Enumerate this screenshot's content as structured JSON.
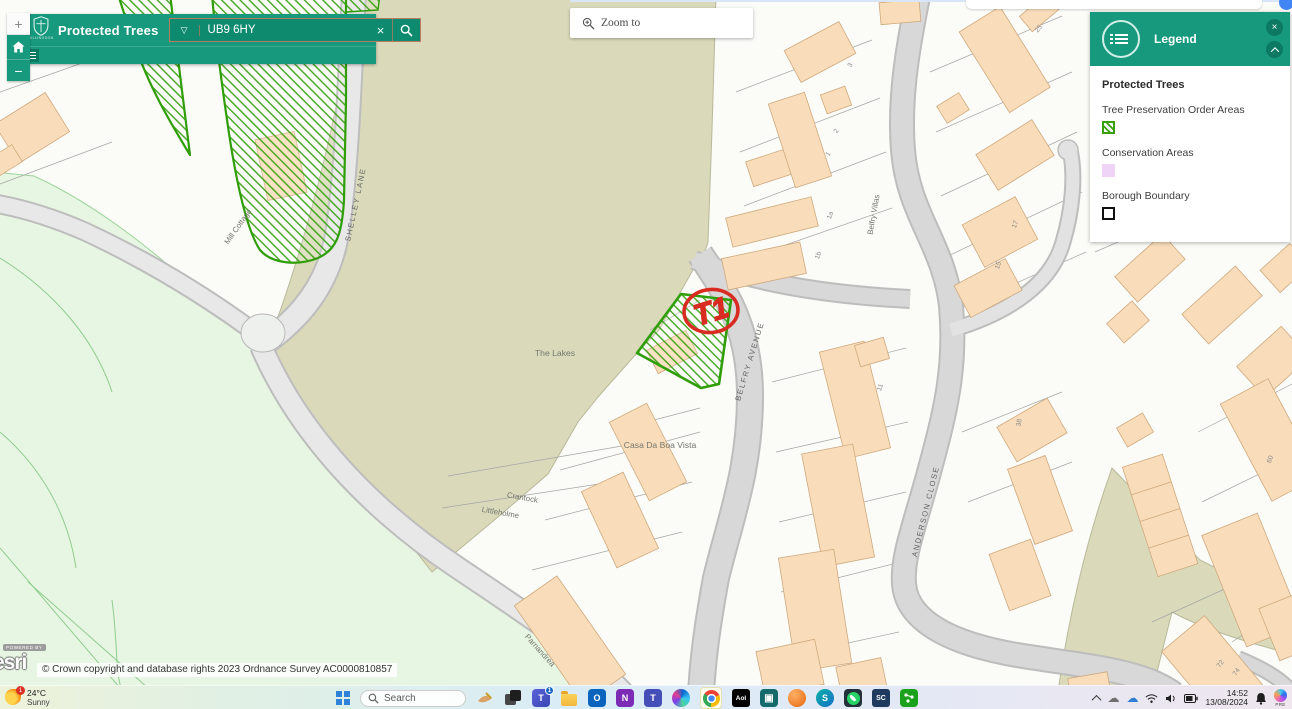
{
  "app": {
    "logo_text": "HILLINGDON",
    "title": "Protected Trees",
    "search": {
      "value": "UB9 6HY"
    },
    "zoom_popup": "Zoom to"
  },
  "map_controls": {
    "zoom_in": "+",
    "zoom_out": "−"
  },
  "legend": {
    "title": "Legend",
    "group_title": "Protected Trees",
    "items": [
      {
        "label": "Tree Preservation Order Areas"
      },
      {
        "label": "Conservation Areas"
      },
      {
        "label": "Borough Boundary"
      }
    ]
  },
  "marker": {
    "label": "T1"
  },
  "map": {
    "labels": [
      {
        "text": "SHELLEY LANE",
        "x": 358,
        "y": 205,
        "r": -78,
        "cls": "road"
      },
      {
        "text": "The Lakes",
        "x": 555,
        "y": 356,
        "r": 0,
        "cls": "place big"
      },
      {
        "text": "Mill Cottage",
        "x": 240,
        "y": 228,
        "r": -55,
        "cls": "place"
      },
      {
        "text": "BELFRY AVENUE",
        "x": 752,
        "y": 362,
        "r": -73,
        "cls": "road"
      },
      {
        "text": "Belfry Villas",
        "x": 876,
        "y": 215,
        "r": -80,
        "cls": "place"
      },
      {
        "text": "ANDERSON CLOSE",
        "x": 928,
        "y": 512,
        "r": -76,
        "cls": "road"
      },
      {
        "text": "Casa Da Boa Vista",
        "x": 660,
        "y": 448,
        "r": 0,
        "cls": "place big"
      },
      {
        "text": "Crantock",
        "x": 522,
        "y": 500,
        "r": 10,
        "cls": "place"
      },
      {
        "text": "Littleholme",
        "x": 500,
        "y": 515,
        "r": 10,
        "cls": "place"
      },
      {
        "text": "Parnandrea",
        "x": 538,
        "y": 652,
        "r": 48,
        "cls": "place"
      },
      {
        "text": "3",
        "x": 852,
        "y": 66,
        "r": -60,
        "cls": "num"
      },
      {
        "text": "2",
        "x": 838,
        "y": 132,
        "r": -60,
        "cls": "num"
      },
      {
        "text": "1",
        "x": 830,
        "y": 155,
        "r": -60,
        "cls": "num"
      },
      {
        "text": "1a",
        "x": 832,
        "y": 216,
        "r": -70,
        "cls": "num"
      },
      {
        "text": "1b",
        "x": 820,
        "y": 256,
        "r": -70,
        "cls": "num"
      },
      {
        "text": "25",
        "x": 1040,
        "y": 30,
        "r": -50,
        "cls": "num"
      },
      {
        "text": "17",
        "x": 1017,
        "y": 225,
        "r": -70,
        "cls": "num"
      },
      {
        "text": "15",
        "x": 1000,
        "y": 266,
        "r": -70,
        "cls": "num"
      },
      {
        "text": "11",
        "x": 882,
        "y": 388,
        "r": -70,
        "cls": "num"
      },
      {
        "text": "38",
        "x": 1021,
        "y": 423,
        "r": -80,
        "cls": "num"
      },
      {
        "text": "60",
        "x": 1272,
        "y": 460,
        "r": -70,
        "cls": "num"
      },
      {
        "text": "72",
        "x": 1222,
        "y": 665,
        "r": -55,
        "cls": "num"
      },
      {
        "text": "74",
        "x": 1238,
        "y": 673,
        "r": -55,
        "cls": "num"
      }
    ]
  },
  "attribution": {
    "powered_by_small": "POWERED BY",
    "powered_by_brand": "esri",
    "text": "© Crown copyright and database rights 2023 Ordnance Survey AC0000810857"
  },
  "taskbar": {
    "weather": {
      "badge": "1",
      "temp": "24°C",
      "condition": "Sunny"
    },
    "search_label": "Search",
    "teams_badge": "1",
    "aol_label": "Aol",
    "teal_glyph": "▣",
    "s_label": "S",
    "sc_label": "SC",
    "outlook_letter": "O",
    "onenote_letter": "N",
    "teams_letter": "T",
    "clock": {
      "time": "14:52",
      "date": "13/08/2024"
    },
    "copilot_label": "PRE"
  },
  "colors": {
    "header_teal": "#17997e",
    "tpo_green": "#2f9e08",
    "conservation_pink": "#f0d4f7",
    "boundary_black": "#111111",
    "marker_red": "#d92b21",
    "building_fill": "#f9ddba",
    "lakes_olive": "#dadabb",
    "grass_green": "#e7f6e2"
  }
}
